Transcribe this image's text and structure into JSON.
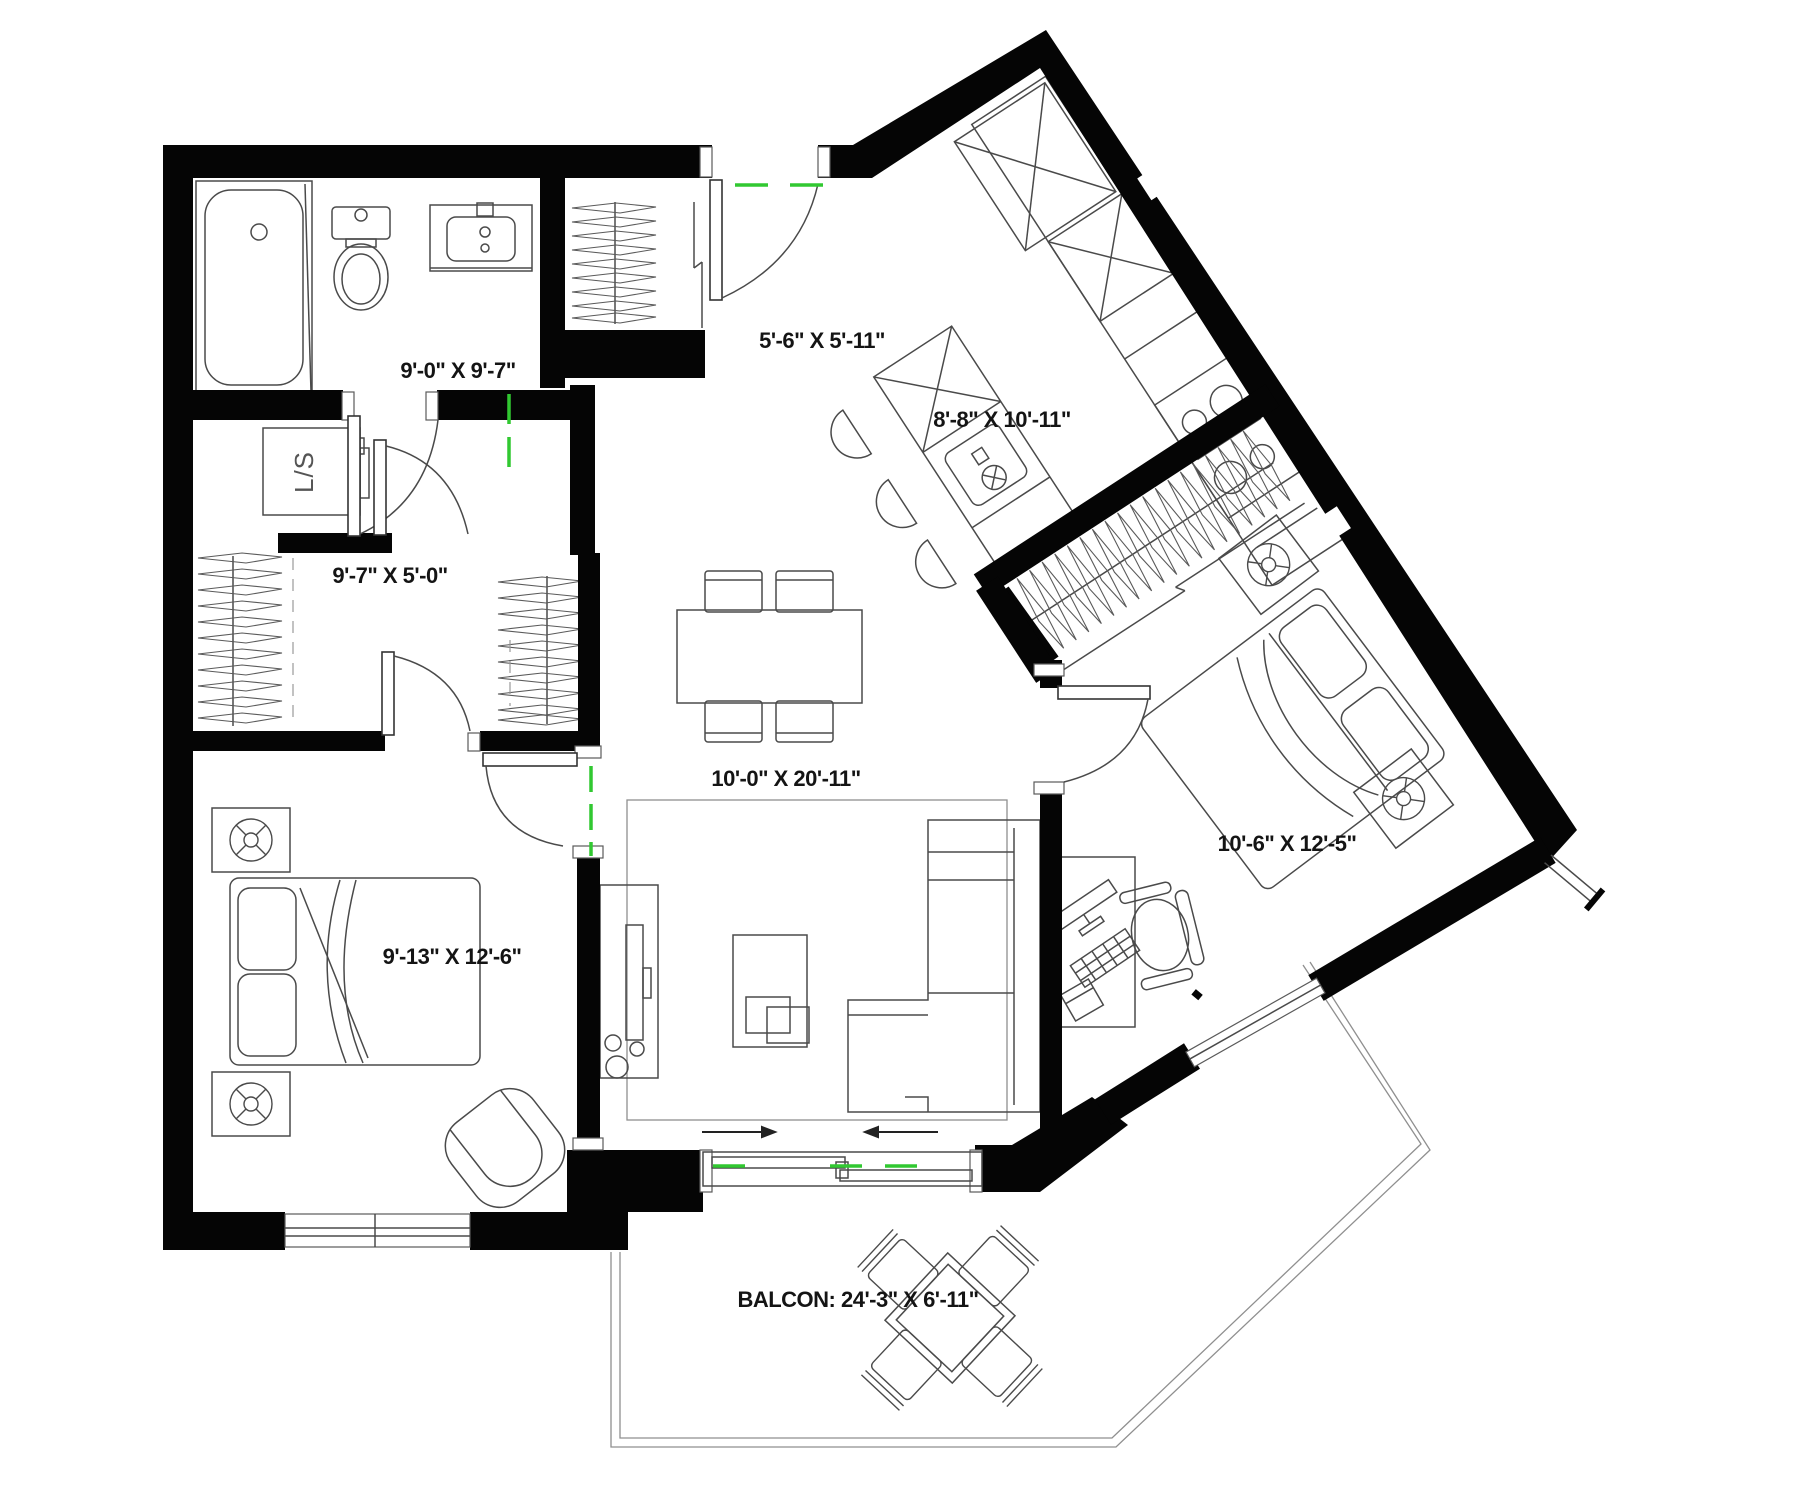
{
  "title": "apartment-floor-plan",
  "colors": {
    "wall": "#050505",
    "furniture_line": "#4a4a4a",
    "light_line": "#8f8f8f",
    "centerline_green": "#31c831",
    "text": "#141414",
    "background": "#ffffff"
  },
  "rooms": {
    "bathroom": {
      "label": "9'-0\" X 9'-7\""
    },
    "laundry": {
      "label": "L/S"
    },
    "walkin_closet": {
      "label": "9'-7\" X 5'-0\""
    },
    "entry": {
      "label": "5'-6\" X 5'-11\""
    },
    "kitchen": {
      "label": "8'-8\" X 10'-11\""
    },
    "living_dining": {
      "label": "10'-0\" X 20'-11\""
    },
    "bedroom_right": {
      "label": "10'-6\" X 12'-5\""
    },
    "bedroom_left": {
      "label": "9'-13\" X 12'-6\""
    },
    "balcony": {
      "label": "BALCON: 24'-3\" X 6'-11\""
    }
  },
  "icons": {
    "hanger": "clothes-hanger-icon",
    "lamp": "circled-lamp-icon",
    "burner": "stove-burner-icon",
    "faucet": "faucet-icon",
    "slide_arrows": "sliding-door-direction-arrows"
  }
}
